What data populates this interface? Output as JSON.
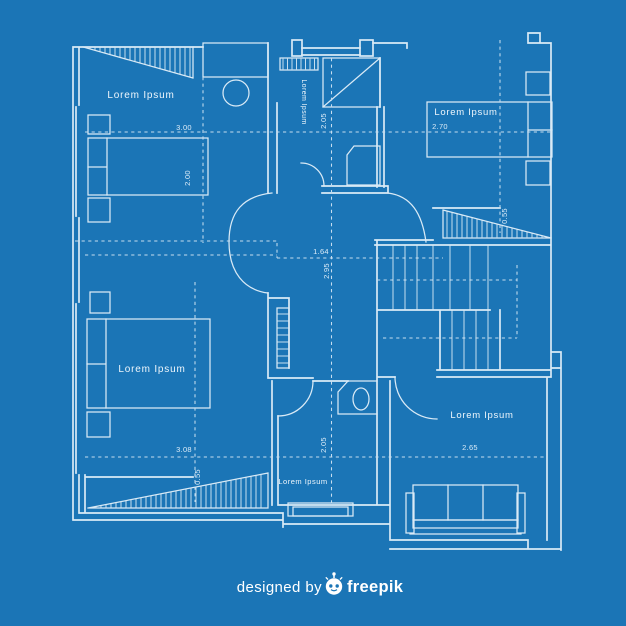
{
  "colors": {
    "background": "#1b75b6",
    "line": "#d9eaf6",
    "dashed_line": "#c6ddef",
    "text": "#eef6fc",
    "footer_text": "#ffffff"
  },
  "rooms": [
    {
      "id": "top-left-bedroom",
      "label": "Lorem Ipsum"
    },
    {
      "id": "top-middle-bathroom",
      "label": "Lorem Ipsum"
    },
    {
      "id": "top-right-bedroom",
      "label": "Lorem Ipsum"
    },
    {
      "id": "bottom-left-bedroom",
      "label": "Lorem Ipsum"
    },
    {
      "id": "bottom-middle-room",
      "label": "Lorem Ipsum"
    },
    {
      "id": "bottom-right-living-room",
      "label": "Lorem Ipsum"
    }
  ],
  "dimensions": [
    {
      "id": "top-left-room-width",
      "value": "3.00"
    },
    {
      "id": "top-left-bed-depth",
      "value": "2.00"
    },
    {
      "id": "bathroom-depth",
      "value": "2.05"
    },
    {
      "id": "top-right-room-width",
      "value": "2.70"
    },
    {
      "id": "stairs-top-offset",
      "value": "0.55"
    },
    {
      "id": "hall-width",
      "value": "1.64"
    },
    {
      "id": "hall-height",
      "value": "2.95"
    },
    {
      "id": "bottom-left-room-width",
      "value": "3.08"
    },
    {
      "id": "bottom-left-ramp-offset",
      "value": "0.55"
    },
    {
      "id": "bottom-middle-room-depth",
      "value": "2.05"
    },
    {
      "id": "living-room-width",
      "value": "2.65"
    }
  ],
  "footer": {
    "prefix": "designed by",
    "brand": "freepik",
    "icon": "freepik-robot-icon"
  }
}
